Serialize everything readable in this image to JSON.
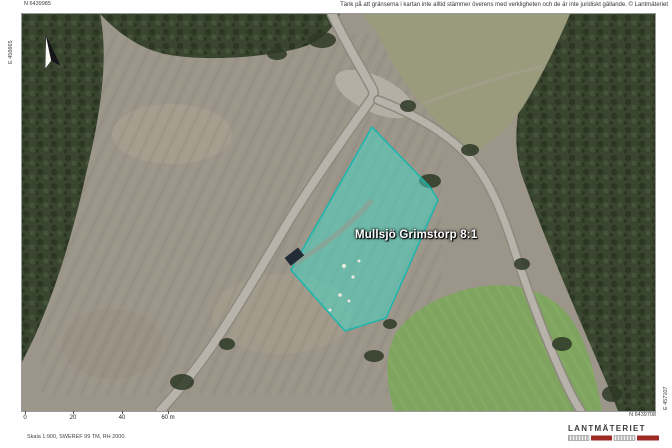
{
  "disclaimer": "Tänk på att gränserna i kartan inte alltid stämmer överens med verkligheten och de är inte juridiskt gällande. © Lantmäteriet",
  "map": {
    "parcel": {
      "label": "Mullsjö Grimstorp 8:1",
      "fill_color": "#3fd9c8",
      "border_color": "#0fb7ae"
    },
    "icons": {
      "north_arrow": "north-arrow"
    },
    "colors": {
      "clearcut": "#9c968a",
      "forest": "#39452f",
      "road": "#b8b3aa",
      "field": "#7ea45f"
    }
  },
  "coordinates": {
    "top_left_n": "N 6439985",
    "left_e": "E 456665",
    "bottom_right_n": "N 6439708",
    "right_e": "E 457107"
  },
  "scale_bar": {
    "ticks": [
      "0",
      "20",
      "40",
      "60 m"
    ]
  },
  "footer": {
    "scale_text": "Skala 1:900, SWEREF 99 TM, RH 2000."
  },
  "logo": {
    "text": "LANTMÄTERIET",
    "bar_red": "#9f2a24",
    "bar_stripe": "#8a8a8a"
  }
}
